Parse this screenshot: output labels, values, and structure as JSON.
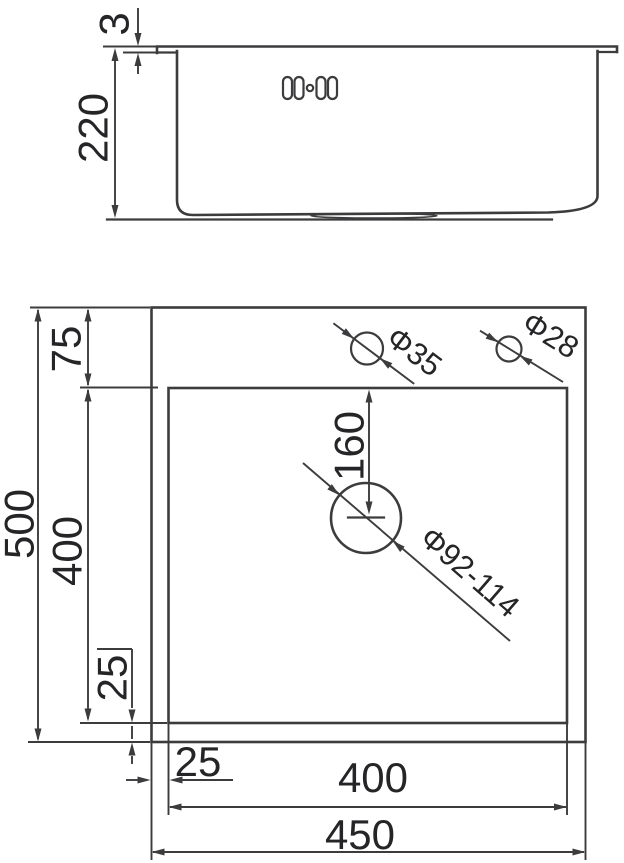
{
  "side_view": {
    "rim_thickness": "3",
    "depth": "220"
  },
  "plan_view": {
    "overall_depth": "500",
    "deck_width": "75",
    "bowl_depth": "400",
    "bottom_inset": "25",
    "left_inset": "25",
    "bowl_width": "400",
    "overall_width": "450",
    "drain_offset": "160",
    "faucet_hole_dia": "Φ35",
    "soap_hole_dia": "Φ28",
    "drain_hole_dia": "Φ92-114"
  },
  "colors": {
    "line": "#3c3c3e",
    "text": "#252527",
    "background": "#ffffff"
  }
}
